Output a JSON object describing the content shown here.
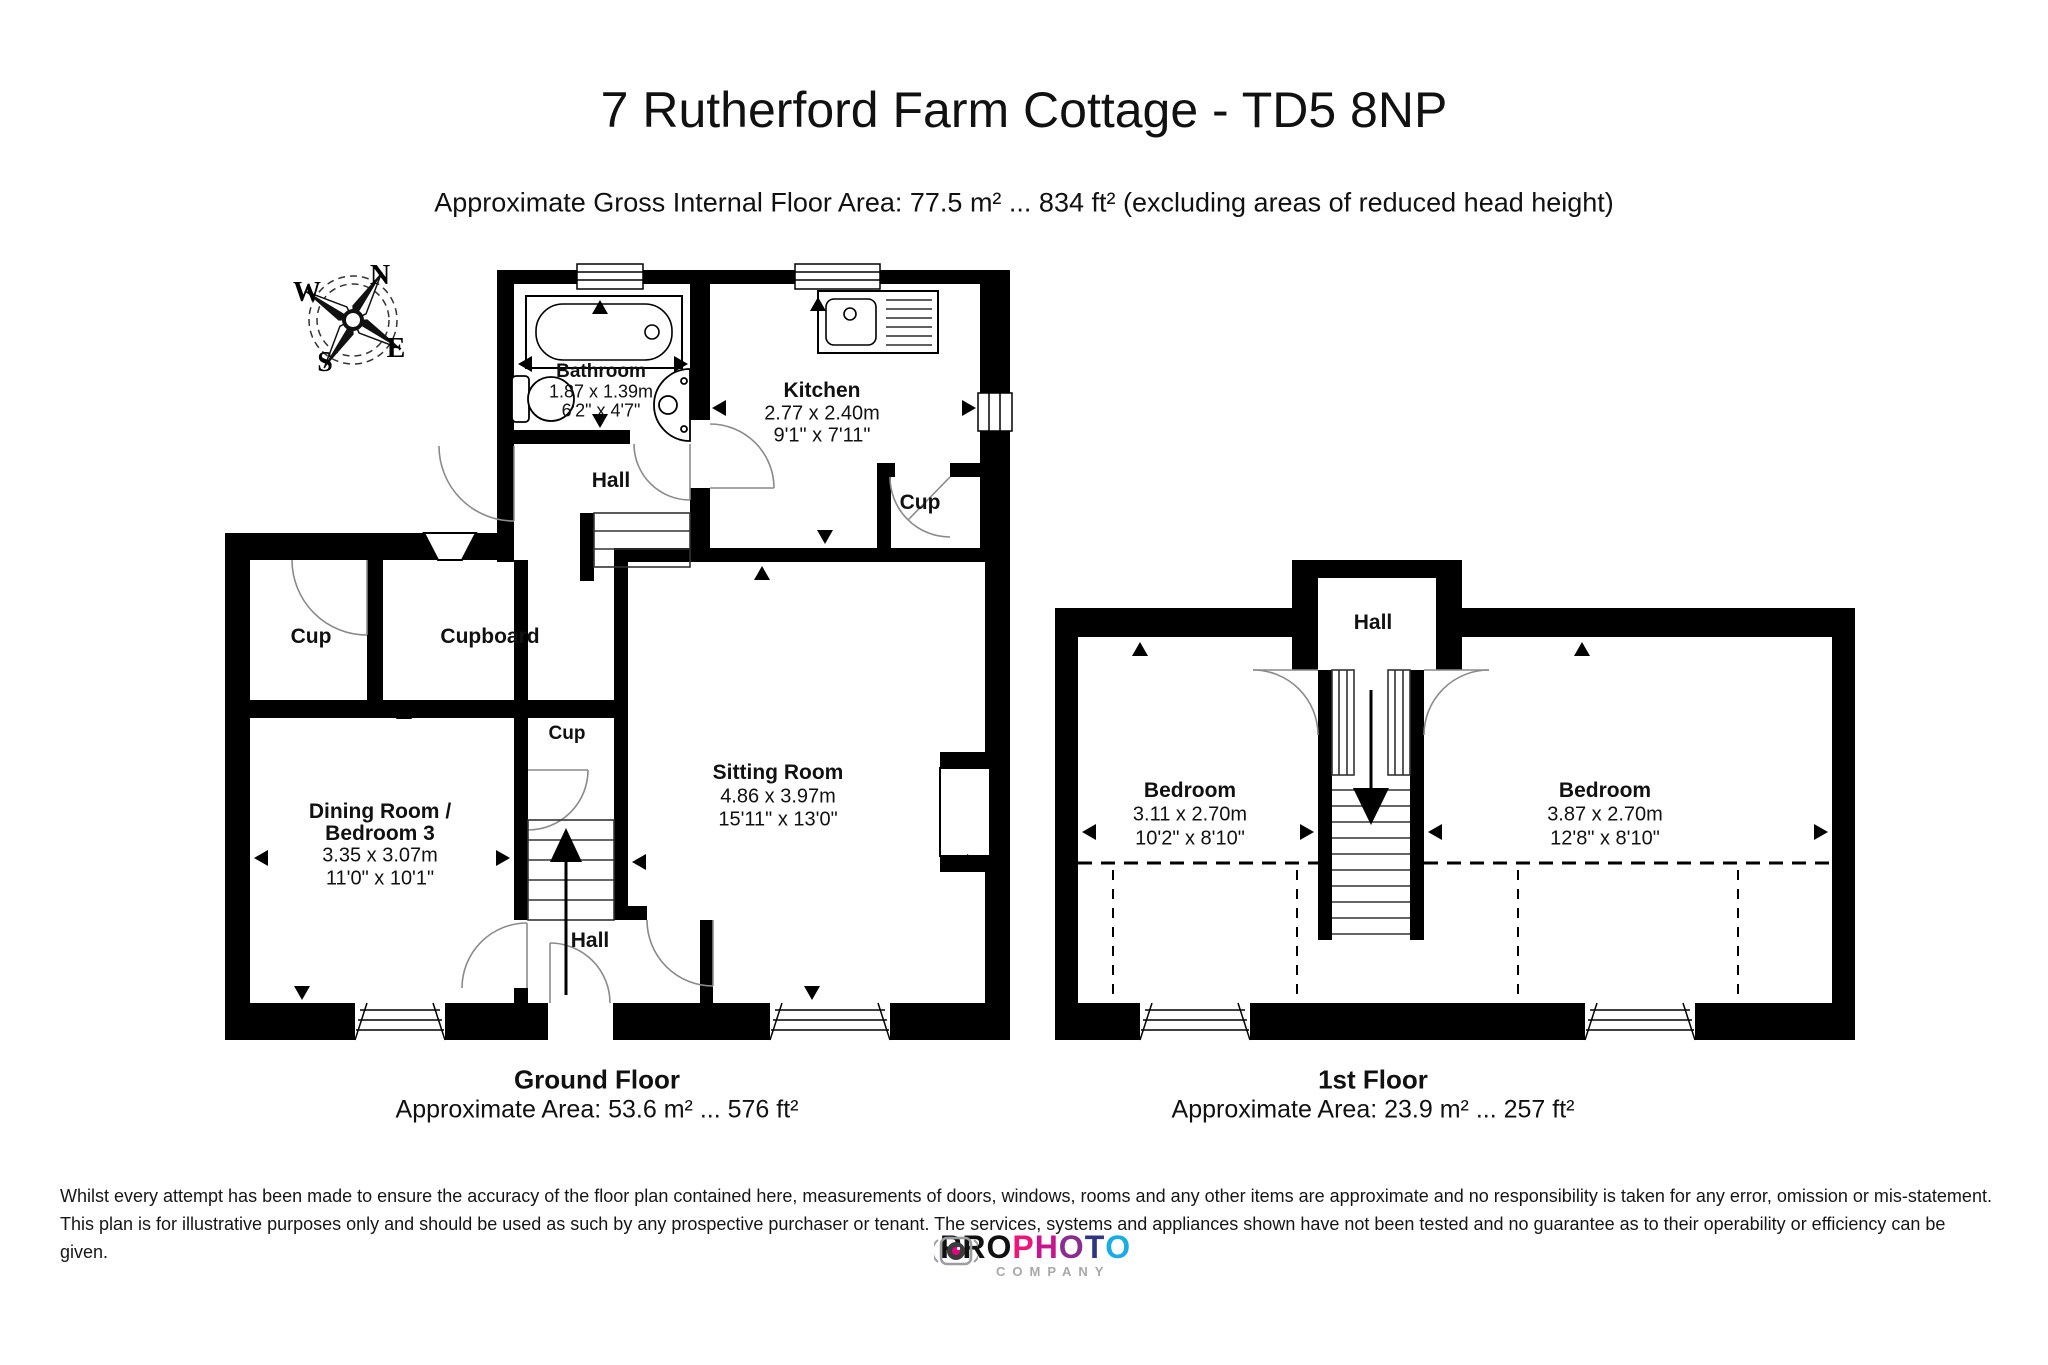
{
  "header": {
    "title": "7 Rutherford Farm Cottage - TD5 8NP",
    "subtitle": "Approximate Gross Internal Floor Area: 77.5 m² ... 834 ft² (excluding areas of reduced head height)"
  },
  "compass": {
    "n": "N",
    "e": "E",
    "s": "S",
    "w": "W"
  },
  "ground_floor": {
    "caption_title": "Ground Floor",
    "caption_area": "Approximate Area: 53.6 m² ... 576 ft²",
    "rooms": {
      "bathroom": {
        "name": "Bathroom",
        "dim_m": "1.87 x 1.39m",
        "dim_ft": "6'2\" x 4'7\""
      },
      "kitchen": {
        "name": "Kitchen",
        "dim_m": "2.77 x 2.40m",
        "dim_ft": "9'1\" x 7'11\""
      },
      "cup_kitchen": {
        "name": "Cup"
      },
      "hall_upper": {
        "name": "Hall"
      },
      "cup_left": {
        "name": "Cup"
      },
      "cupboard": {
        "name": "Cupboard"
      },
      "cup_stairs": {
        "name": "Cup"
      },
      "dining": {
        "name1": "Dining Room /",
        "name2": "Bedroom 3",
        "dim_m": "3.35 x 3.07m",
        "dim_ft": "11'0\" x 10'1\""
      },
      "sitting": {
        "name": "Sitting Room",
        "dim_m": "4.86 x 3.97m",
        "dim_ft": "15'11\" x 13'0\""
      },
      "hall_lower": {
        "name": "Hall"
      }
    }
  },
  "first_floor": {
    "caption_title": "1st Floor",
    "caption_area": "Approximate Area: 23.9 m² ... 257 ft²",
    "rooms": {
      "hall": {
        "name": "Hall"
      },
      "bedroom_left": {
        "name": "Bedroom",
        "dim_m": "3.11 x 2.70m",
        "dim_ft": "10'2\" x 8'10\""
      },
      "bedroom_right": {
        "name": "Bedroom",
        "dim_m": "3.87 x 2.70m",
        "dim_ft": "12'8\" x 8'10\""
      }
    }
  },
  "disclaimer": {
    "line1": "Whilst every attempt has been made to ensure the accuracy of the floor plan contained here, measurements of doors, windows, rooms and any other items are approximate and no responsibility is taken for any error, omission or mis-statement.",
    "line2": "This plan is for illustrative purposes only and should be used as such by any prospective purchaser or tenant. The services, systems and appliances shown have not been tested and no guarantee as to their operability or efficiency can be given."
  },
  "logo": {
    "pro": "PRO",
    "letters": [
      {
        "ch": "P",
        "color": "#ee1777"
      },
      {
        "ch": "H",
        "color": "#c6168d"
      },
      {
        "ch": "O",
        "color": "#8a2d8f"
      },
      {
        "ch": "T",
        "color": "#2d3580"
      },
      {
        "ch": "O",
        "color": "#1aade3"
      }
    ],
    "company": "COMPANY",
    "pro_color": "#111111",
    "camera_body_color": "#9b9da0",
    "camera_lens_color": "#3a3a3a",
    "camera_dot_color": "#e6007e"
  }
}
